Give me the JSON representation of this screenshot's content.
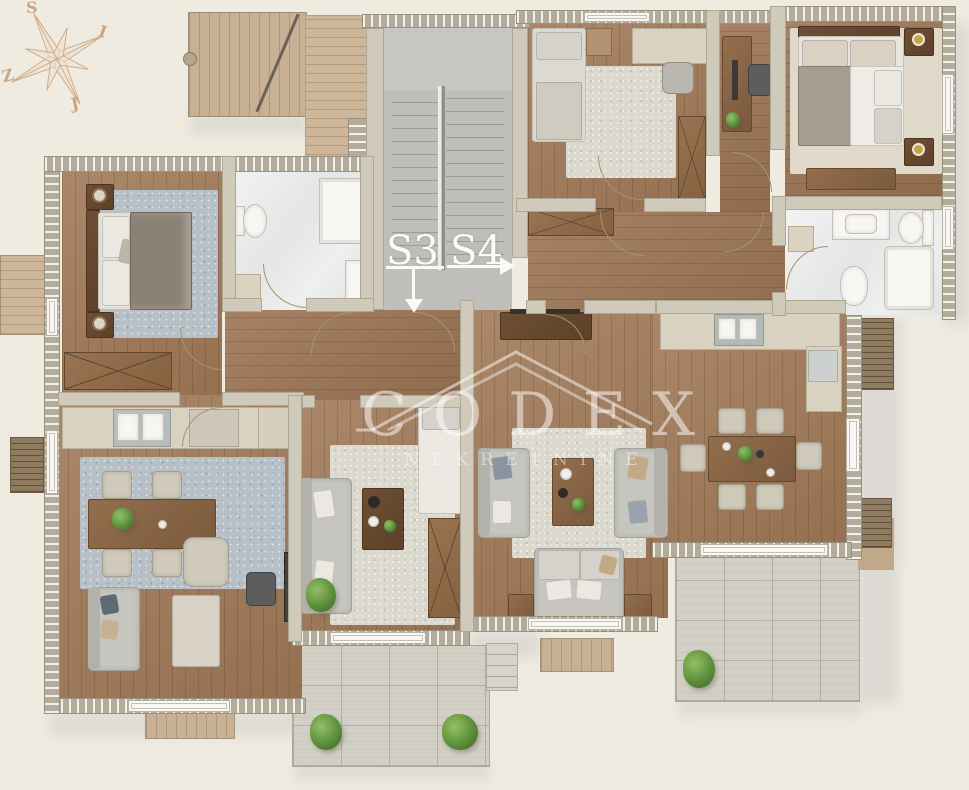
{
  "compass": {
    "top": "S",
    "right": "I",
    "bottom": "J",
    "left": "Z"
  },
  "units": {
    "s3": {
      "label": "S3",
      "arrow": "down"
    },
    "s4": {
      "label": "S4",
      "arrow": "right"
    }
  },
  "watermark": {
    "brand": "CODEX",
    "tagline": "NEKRETNINE"
  },
  "palette": {
    "background": "#f0ebe1",
    "wall_outer": "#b3ab9c",
    "wall_inner": "#d0cabb",
    "wood_floor": "#a17a58",
    "deck_wood": "#c8b094",
    "tile": "#eef0ef",
    "rug_blue": "#b7bfc7",
    "rug_light": "#dbd8ce",
    "paving": "#d2cfc5",
    "plant_green": "#6fa04c",
    "compass_tan": "#c9a683",
    "label_white": "#fafaf7"
  }
}
